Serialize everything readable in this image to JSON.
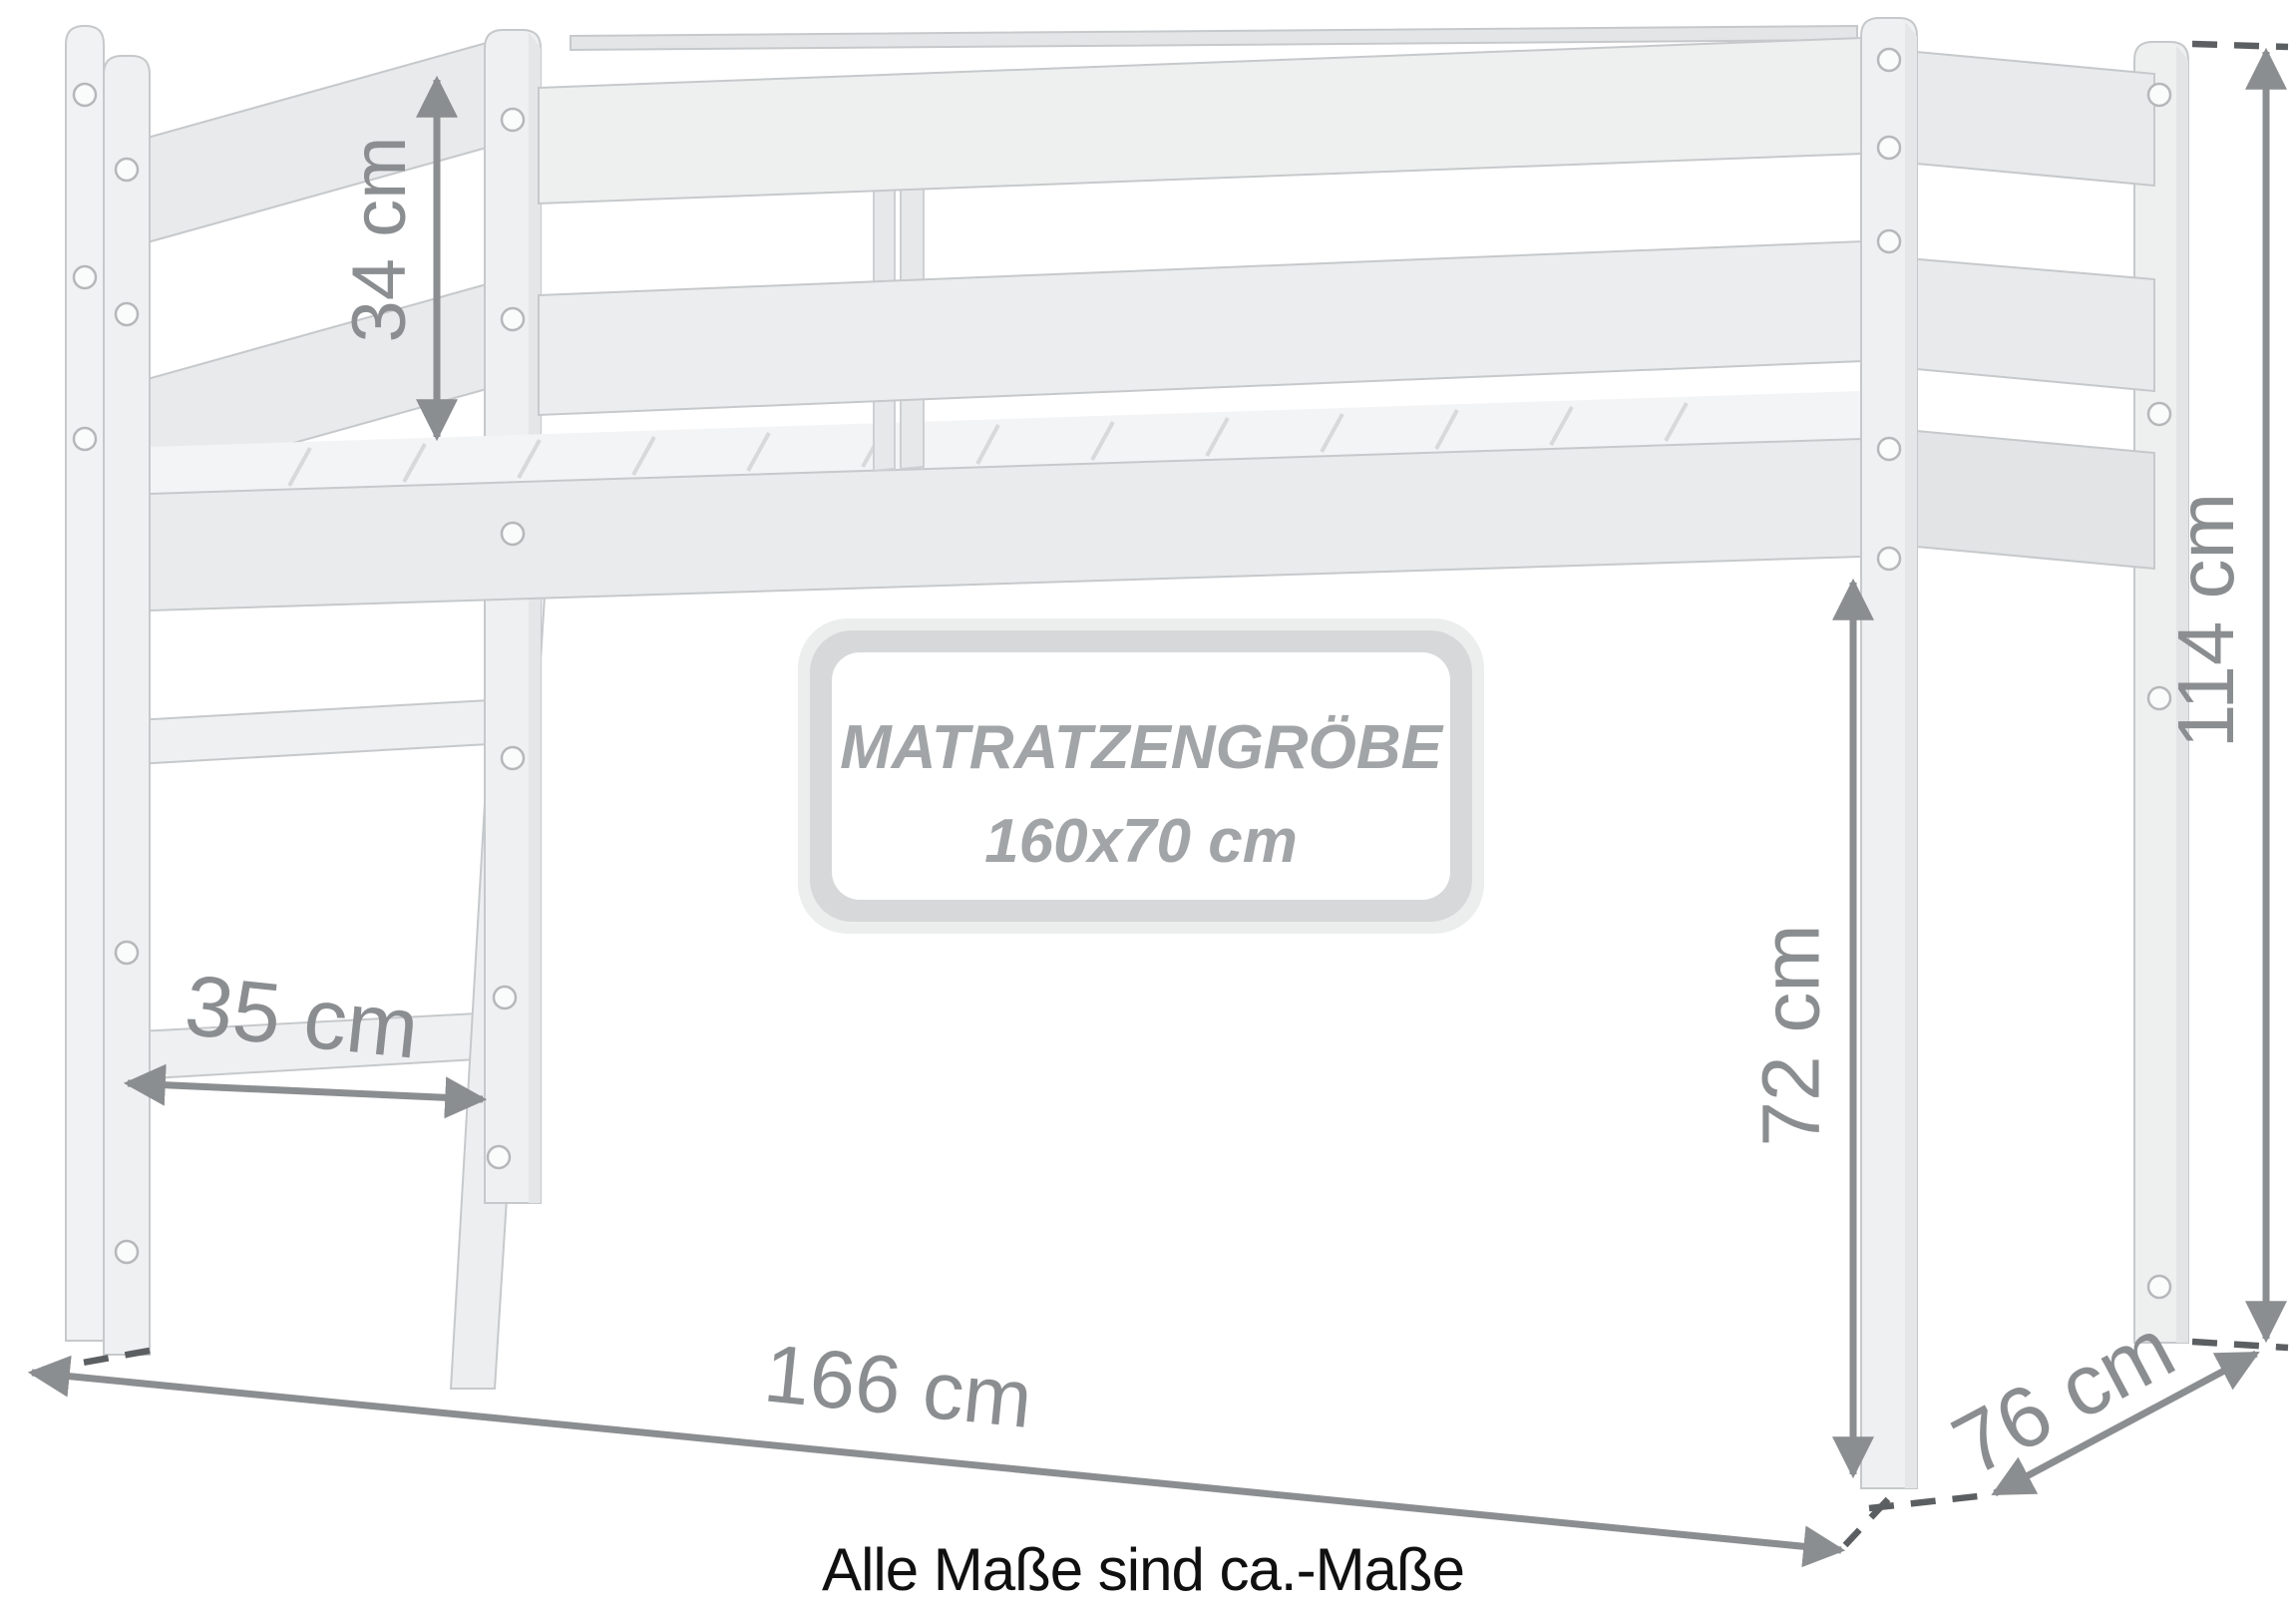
{
  "diagram": {
    "type": "loft-bed-dimension-drawing",
    "dimensions": {
      "guard_rail_height": "34 cm",
      "ladder_step_width": "35 cm",
      "bed_length": "166 cm",
      "bed_depth": "76 cm",
      "under_bed_clearance": "72 cm",
      "total_height": "114 cm"
    },
    "mattress_label": {
      "title": "MATRATZENGRÖBE",
      "size": "160x70 cm"
    },
    "footnote": "Alle Maße sind ca.-Maße",
    "colors": {
      "wood_light": "#EFF0F1",
      "wood_mid": "#E9EBEC",
      "wood_shade": "#E2E4E6",
      "outline": "#C6C9CB",
      "dimension": "#8B8E90",
      "dash": "#5C5F61",
      "label_rim": "#D6D8D9",
      "label_text": "#A2A5A7",
      "footnote_text": "#101010"
    }
  }
}
